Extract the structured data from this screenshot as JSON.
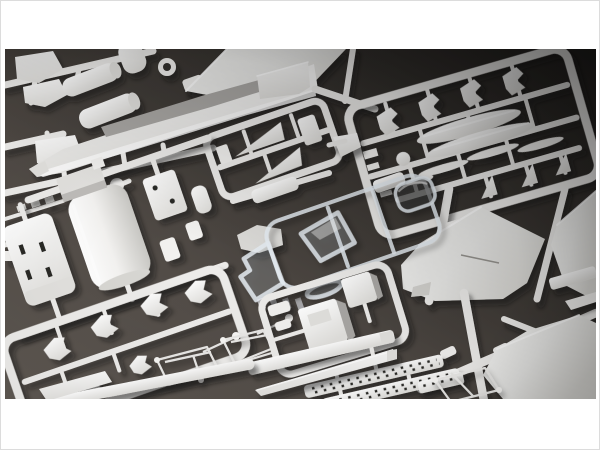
{
  "window": {
    "width": 600,
    "height": 450
  },
  "photo": {
    "alt": "Overhead photograph of an aircraft plastic model kit: several white injection-molded sprues with parts (fuselage spine, delta wing panels, drop tanks, missiles, intakes, landing-gear pieces, nose cone, strips with molded holes) and one clear sprue with canopy and windscreen, laid diagonally on a dark charcoal surface inside a white matte.",
    "x": 4,
    "y": 48,
    "width": 591,
    "height": 350
  },
  "palette": {
    "matte": "#ffffff",
    "matte_border": "#dcdcdc",
    "bg_deep": "#22201e",
    "bg_dark": "#3a3632",
    "bg_mid": "#524c47",
    "bg_light": "#5e5852",
    "plastic_hi": "#ffffff",
    "plastic": "#f2f1ef",
    "plastic_lo": "#e2e1de",
    "plastic_side": "#a9a7a4",
    "runner": "#edecea",
    "wire": "#e9e8e6",
    "clear_rim": "rgba(231,238,245,0.85)",
    "clear_fill": "rgba(206,216,229,0.16)",
    "slot_dark": "#2b2927"
  },
  "scene": {
    "objects": [
      {
        "id": "sprue-top-left",
        "label": "Sprue with drop-tank halves, wedge fins and ring part"
      },
      {
        "id": "fuselage-spine",
        "label": "Long upper-fuselage spine part with shaded side face"
      },
      {
        "id": "delta-wing-top",
        "label": "Large delta wing panel cropped by top edge"
      },
      {
        "id": "sprue-tail-fins",
        "label": "Small sprue frame holding tail-fin parts"
      },
      {
        "id": "sprue-weapons",
        "label": "Large weapons sprue: drop tanks, slender missiles, pylons, fin bowties"
      },
      {
        "id": "fuselage-sections-sprue",
        "label": "Half-cylinder fuselage sections, slotted box part, bracket"
      },
      {
        "id": "clear-canopy-sprue",
        "label": "Clear sprue with windscreen, canopy bubble and sill piece"
      },
      {
        "id": "sprue-landing-gear",
        "label": "Sprue frame with small landing-gear parts"
      },
      {
        "id": "gear-door-outlines",
        "label": "Thin wire-like runner frames with ball-ended sprue gates"
      },
      {
        "id": "sprue-intakes",
        "label": "Sprue frame with box-shaped intake parts"
      },
      {
        "id": "flare-strips",
        "label": "Long strips with rows of molded dark holes"
      },
      {
        "id": "nose-cone",
        "label": "Pointed nose-cone part"
      },
      {
        "id": "wing-panels",
        "label": "Large flat wing panels at right and bottom-right"
      },
      {
        "id": "bottom-right-runners",
        "label": "Thick runner bars with small tabs"
      }
    ]
  }
}
